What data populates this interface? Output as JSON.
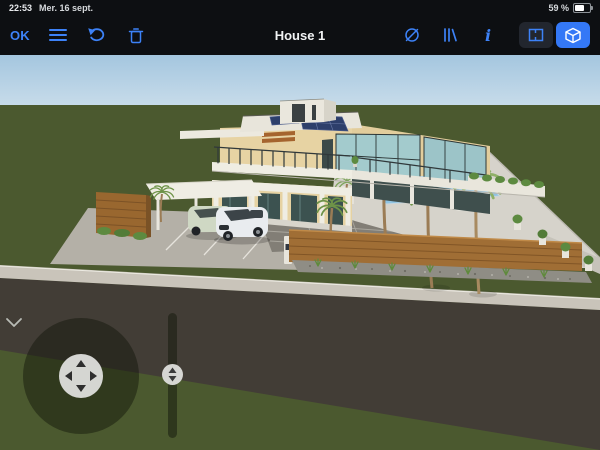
{
  "status_bar": {
    "time": "22:53",
    "date": "Mer. 16 sept.",
    "battery_percent": "59 %"
  },
  "toolbar": {
    "ok_label": "OK",
    "title": "House 1",
    "left_icons": [
      "menu-icon",
      "undo-icon",
      "trash-icon"
    ],
    "right_icons": [
      "visibility-off-icon",
      "catalog-books-icon",
      "info-icon"
    ],
    "view_toggle": {
      "options": [
        "2d-plan-view",
        "3d-view"
      ],
      "active": "3d-view"
    },
    "accent_color": "#3d82f7",
    "bar_background": "#0d0f12"
  },
  "viewport": {
    "scene": "3d-house-exterior-render",
    "colors": {
      "sky_top": "#a4c6df",
      "sky_bottom": "#c8dcea",
      "grass": "#4b592f",
      "road": "#423d36",
      "sidewalk": "#c9c4ba",
      "driveway": "#b4b0a7",
      "pavers": "#827e76",
      "house_wall": "#e7d3a3",
      "house_trim": "#efede3",
      "glass_dark": "#3c5250",
      "glass_light": "#a3cbcd",
      "solar_panel": "#2d3f6b",
      "pool_water": "#8fc3e2",
      "wood_fence": "#a06e35",
      "palm_green": "#6e9348",
      "umbrella_orange": "#cd7722"
    }
  },
  "controls": {
    "joystick": "move-camera-joystick",
    "height_slider": "camera-height-slider",
    "collapse": "hide-controls-chevron"
  }
}
